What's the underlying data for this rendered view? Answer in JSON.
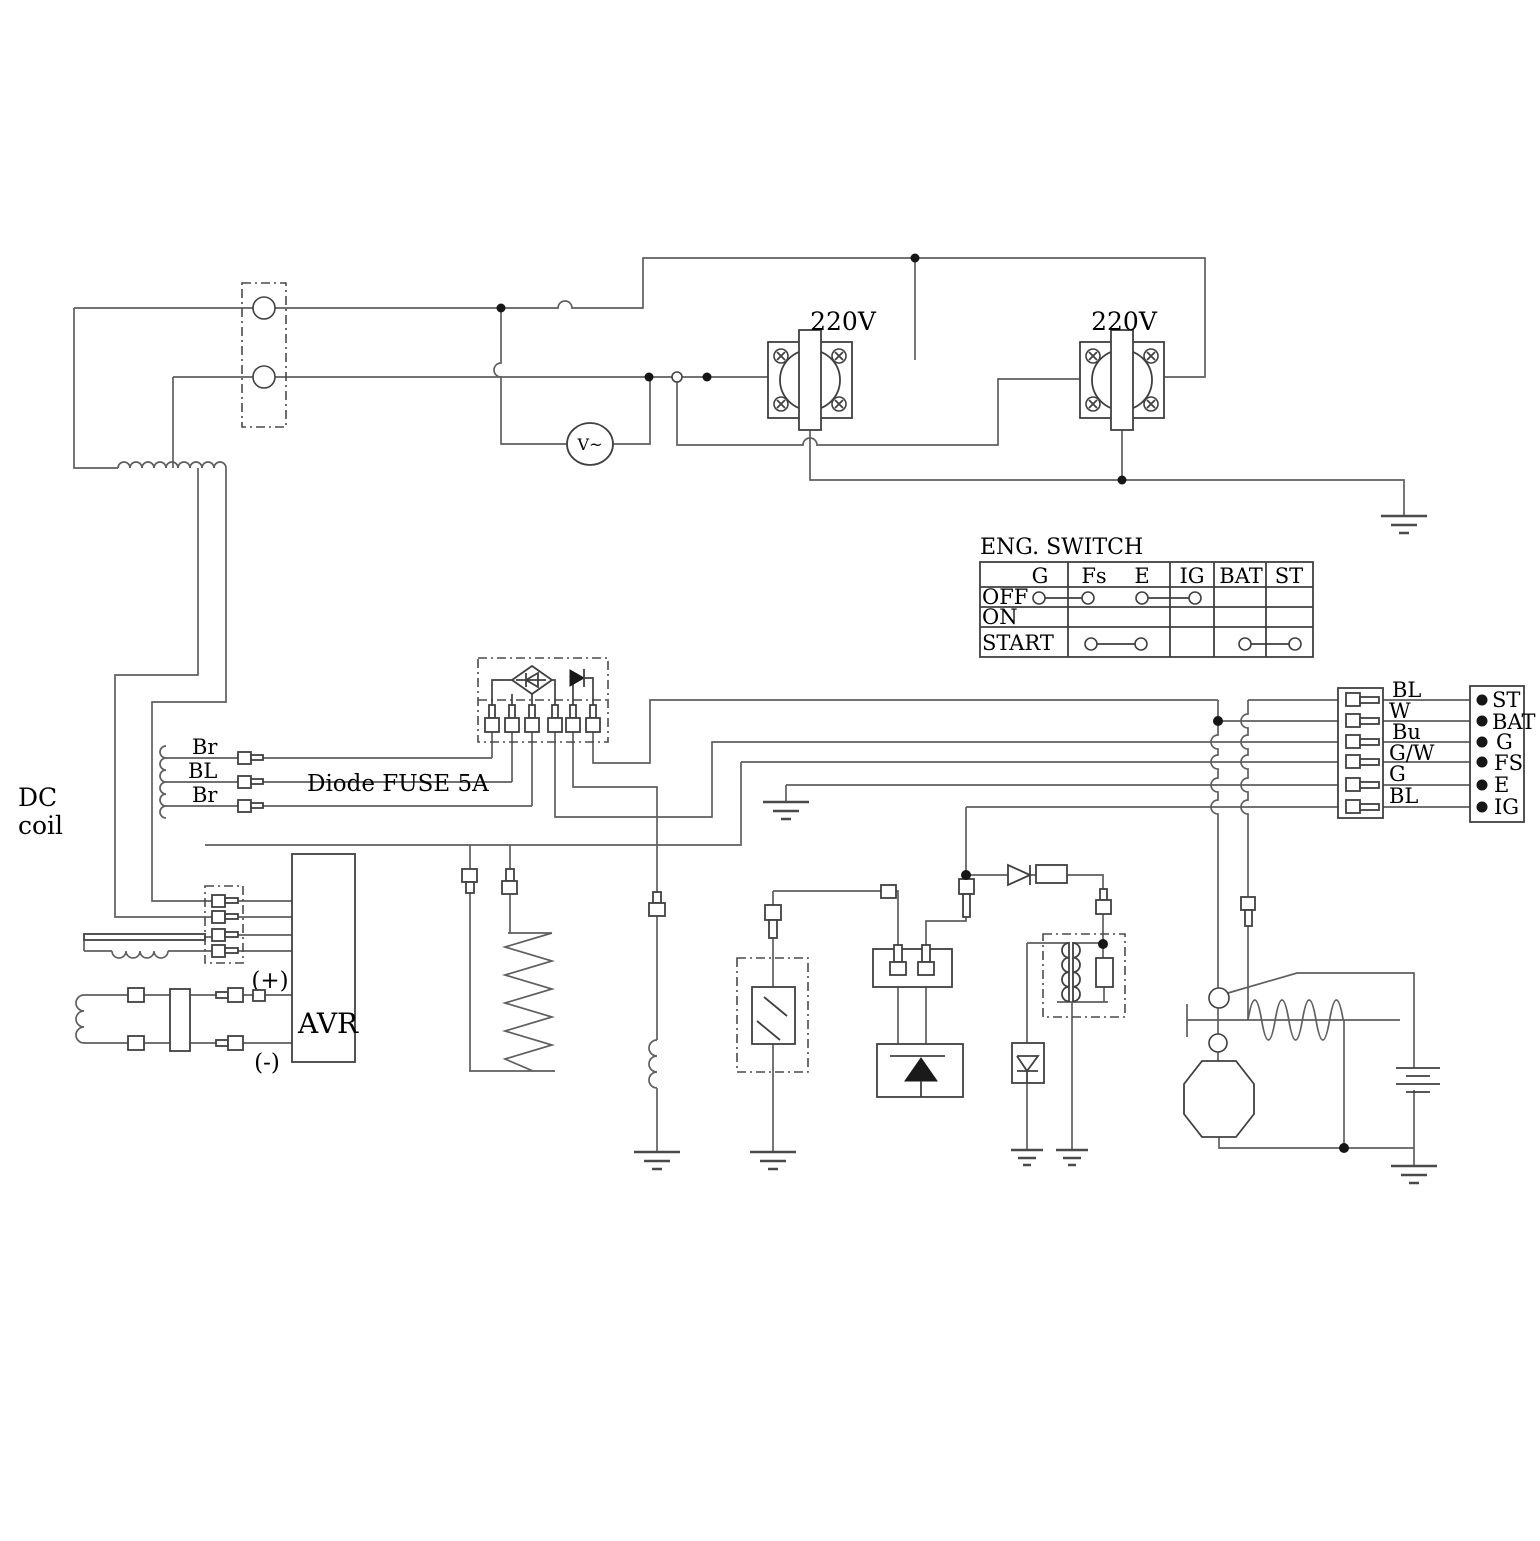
{
  "labels": {
    "voltage_left": "220V",
    "voltage_right": "220V",
    "voltmeter": "V~",
    "dc_coil_line1": "DC",
    "dc_coil_line2": "coil",
    "wire_color_top": "Br",
    "wire_color_mid": "BL",
    "wire_color_bottom": "Br",
    "diode_fuse": "Diode FUSE 5A",
    "avr": "AVR",
    "plus": "(+)",
    "minus": "(-)"
  },
  "eng_switch": {
    "title": "ENG. SWITCH",
    "columns": [
      "G",
      "Fs",
      "E",
      "IG",
      "BAT",
      "ST"
    ],
    "rows": [
      "OFF",
      "ON",
      "START"
    ],
    "connections": [
      {
        "row": "OFF",
        "closed": [
          [
            "G",
            "Fs"
          ],
          [
            "E",
            "IG"
          ]
        ]
      },
      {
        "row": "ON",
        "closed": []
      },
      {
        "row": "START",
        "closed": [
          [
            "Fs",
            "E"
          ],
          [
            "BAT",
            "ST"
          ]
        ]
      }
    ]
  },
  "harness_connector": {
    "wire_labels": [
      "BL",
      "W",
      "Bu",
      "G/W",
      "G",
      "BL"
    ],
    "terminals": [
      "ST",
      "BAT",
      "G",
      "FS",
      "E",
      "IG"
    ]
  }
}
